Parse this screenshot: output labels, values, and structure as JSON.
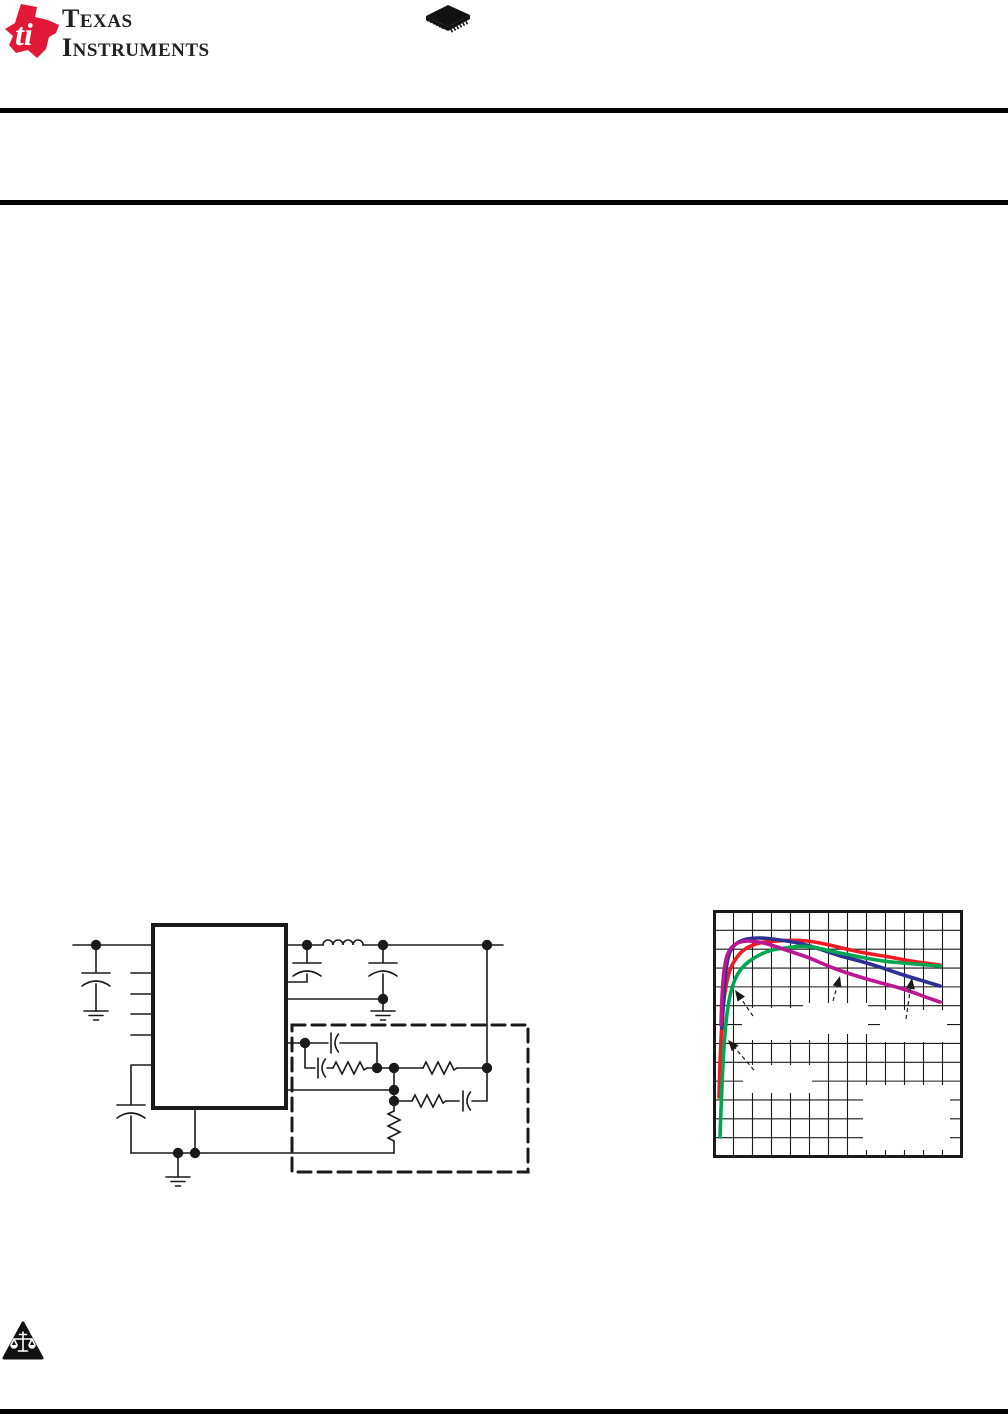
{
  "header": {
    "brand": {
      "line1_initial": "T",
      "line1_rest": "EXAS",
      "line2_initial": "I",
      "line2_rest": "NSTRUMENTS"
    },
    "logo_red": "#e31837",
    "text_color": "#231f20",
    "package_icon": "qfn-package-icon"
  },
  "rules": {
    "color": "#000000",
    "count": 3
  },
  "footer": {
    "warning_icon": "legal-scales-triangle-icon"
  },
  "schematic": {
    "description": "typical-application-circuit",
    "line_color": "#1a1a1a",
    "elements": [
      "ic-block",
      "input-capacitor",
      "output-inductor",
      "output-capacitors",
      "ground-symbols",
      "compensation-network-dashed-box",
      "resistors",
      "capacitors"
    ]
  },
  "chart_data": {
    "type": "line",
    "title": "",
    "xlabel": "",
    "ylabel": "",
    "axis_tick_labels_visible": false,
    "frame_color": "#1a1a1a",
    "grid": {
      "cols": 13,
      "rows": 13,
      "color": "#1a1a1a",
      "on": true
    },
    "plot_box": {
      "x": 1.5,
      "y": 1.5,
      "width": 247,
      "height": 245
    },
    "series": [
      {
        "name": "series-red",
        "color": "#ed1c24",
        "points": [
          [
            6,
            187
          ],
          [
            7,
            150
          ],
          [
            9,
            110
          ],
          [
            12,
            80
          ],
          [
            16,
            62
          ],
          [
            20,
            53
          ],
          [
            24,
            47
          ],
          [
            29,
            41
          ],
          [
            37,
            36
          ],
          [
            49,
            32
          ],
          [
            64,
            31
          ],
          [
            80,
            30
          ],
          [
            97,
            31
          ],
          [
            117,
            35
          ],
          [
            137,
            40
          ],
          [
            157,
            44
          ],
          [
            177,
            47
          ],
          [
            197,
            51
          ],
          [
            212,
            53
          ],
          [
            227,
            55
          ]
        ]
      },
      {
        "name": "series-blue",
        "color": "#2e3192",
        "points": [
          [
            9,
            118
          ],
          [
            11,
            75
          ],
          [
            15,
            45
          ],
          [
            21,
            35
          ],
          [
            29,
            30
          ],
          [
            39,
            28
          ],
          [
            52,
            28
          ],
          [
            67,
            30
          ],
          [
            87,
            33
          ],
          [
            107,
            39
          ],
          [
            127,
            46
          ],
          [
            147,
            51
          ],
          [
            167,
            57
          ],
          [
            187,
            64
          ],
          [
            207,
            70
          ],
          [
            227,
            76
          ]
        ]
      },
      {
        "name": "series-green",
        "color": "#00a551",
        "points": [
          [
            7,
            227
          ],
          [
            9,
            170
          ],
          [
            12,
            120
          ],
          [
            16,
            88
          ],
          [
            22,
            68
          ],
          [
            30,
            56
          ],
          [
            42,
            47
          ],
          [
            57,
            40
          ],
          [
            72,
            38
          ],
          [
            87,
            36
          ],
          [
            102,
            37
          ],
          [
            117,
            41
          ],
          [
            137,
            45
          ],
          [
            157,
            49
          ],
          [
            177,
            52
          ],
          [
            202,
            54
          ],
          [
            227,
            56
          ]
        ]
      },
      {
        "name": "series-magenta",
        "color": "#bb1693",
        "points": [
          [
            8,
            115
          ],
          [
            9,
            80
          ],
          [
            12,
            52
          ],
          [
            16,
            40
          ],
          [
            22,
            34
          ],
          [
            30,
            31
          ],
          [
            39,
            31
          ],
          [
            52,
            33
          ],
          [
            67,
            38
          ],
          [
            82,
            43
          ],
          [
            97,
            48
          ],
          [
            117,
            57
          ],
          [
            137,
            64
          ],
          [
            157,
            70
          ],
          [
            172,
            74
          ],
          [
            187,
            78
          ],
          [
            202,
            83
          ],
          [
            215,
            88
          ],
          [
            227,
            92
          ]
        ]
      }
    ],
    "annotations": {
      "arrow_color": "#1a1a1a",
      "arrows": [
        {
          "target": "series-red",
          "head": [
            22,
            80
          ],
          "tail": [
            40,
            106
          ]
        },
        {
          "target": "series-green",
          "head": [
            15,
            130
          ],
          "tail": [
            41,
            160
          ]
        },
        {
          "target": "series-magenta",
          "head": [
            127,
            66
          ],
          "tail": [
            120,
            91
          ]
        },
        {
          "target": "series-blue",
          "head": [
            199,
            68
          ],
          "tail": [
            193,
            109
          ]
        }
      ],
      "label_placeholders": [
        {
          "x": 29,
          "y": 98,
          "width": 70,
          "height": 32
        },
        {
          "x": 90,
          "y": 93,
          "width": 65,
          "height": 31
        },
        {
          "x": 167,
          "y": 100,
          "width": 67,
          "height": 32
        },
        {
          "x": 30,
          "y": 155,
          "width": 69,
          "height": 28
        },
        {
          "x": 150,
          "y": 175,
          "width": 87,
          "height": 65
        }
      ]
    }
  }
}
